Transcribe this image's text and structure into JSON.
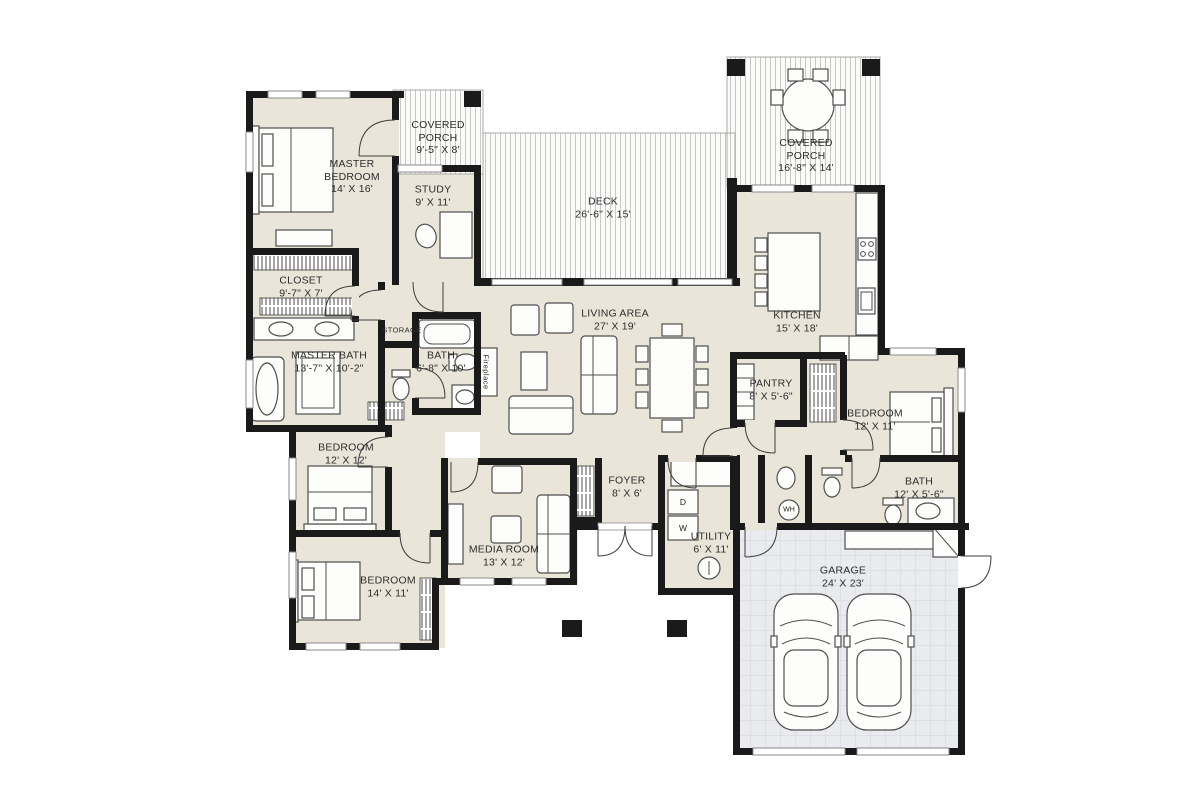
{
  "plan": {
    "type": "residential-floor-plan",
    "colors": {
      "wall": "#1a1a1a",
      "interior_floor": "#eae5d9",
      "deck_stripe": "#c8c8c6",
      "garage_floor": "#e9ebef",
      "garage_grid": "#d2d5dc"
    },
    "rooms": [
      {
        "id": "master-bedroom",
        "name": "MASTER BEDROOM",
        "dims": "14' X 16'"
      },
      {
        "id": "study",
        "name": "STUDY",
        "dims": "9' X 11'"
      },
      {
        "id": "covered-porch-left",
        "name": "COVERED PORCH",
        "dims": "9'-5\" X 8'"
      },
      {
        "id": "deck",
        "name": "DECK",
        "dims": "26'-6\" X 15'"
      },
      {
        "id": "covered-porch-right",
        "name": "COVERED PORCH",
        "dims": "16'-8\" X 14'"
      },
      {
        "id": "kitchen",
        "name": "KITCHEN",
        "dims": "15' X 18'"
      },
      {
        "id": "living-area",
        "name": "LIVING AREA",
        "dims": "27' X 19'"
      },
      {
        "id": "closet",
        "name": "CLOSET",
        "dims": "9'-7\" X 7'"
      },
      {
        "id": "master-bath",
        "name": "MASTER BATH",
        "dims": "13'-7\" X 10'-2\""
      },
      {
        "id": "bath-hall",
        "name": "BATH",
        "dims": "6'-8\" X 10'"
      },
      {
        "id": "storage",
        "name": "STORAGE",
        "dims": ""
      },
      {
        "id": "pantry",
        "name": "PANTRY",
        "dims": "8' X 5'-6\""
      },
      {
        "id": "bedroom-right",
        "name": "BEDROOM",
        "dims": "12' X 11'"
      },
      {
        "id": "bath-right",
        "name": "BATH",
        "dims": "12' X 5'-6\""
      },
      {
        "id": "bedroom-mid",
        "name": "BEDROOM",
        "dims": "12' X 12'"
      },
      {
        "id": "bedroom-bottom",
        "name": "BEDROOM",
        "dims": "14' X 11'"
      },
      {
        "id": "media-room",
        "name": "MEDIA ROOM",
        "dims": "13' X 12'"
      },
      {
        "id": "foyer",
        "name": "FOYER",
        "dims": "8' X 6'"
      },
      {
        "id": "utility",
        "name": "UTILITY",
        "dims": "6' X 11'"
      },
      {
        "id": "garage",
        "name": "GARAGE",
        "dims": "24' X 23'"
      }
    ],
    "fixtures": {
      "fireplace": "Fireplace",
      "dryer": "D",
      "washer": "W",
      "water_heater": "WH"
    }
  }
}
